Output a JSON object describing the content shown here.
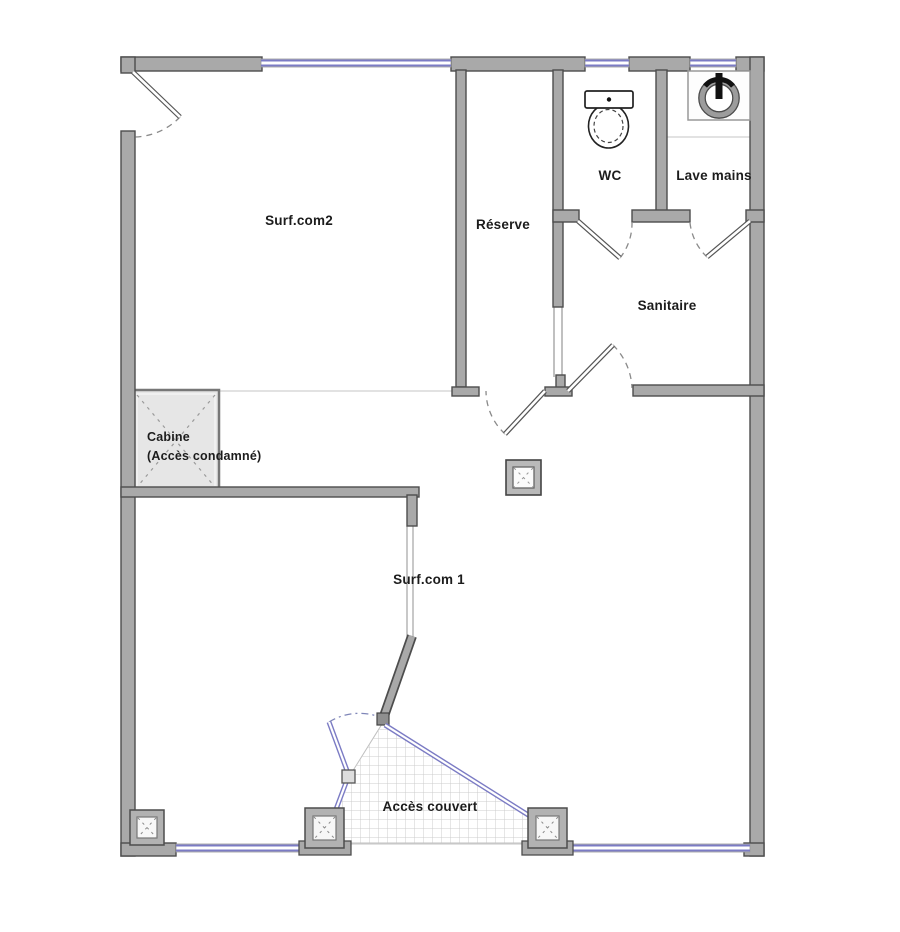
{
  "plan": {
    "rooms": {
      "surfcom2": "Surf.com2",
      "reserve": "Réserve",
      "wc": "WC",
      "lave_mains": "Lave mains",
      "sanitaire": "Sanitaire",
      "cabine": "Cabine",
      "cabine_note": "(Accès condamné)",
      "surfcom1": "Surf.com 1",
      "acces_couvert": "Accès couvert"
    },
    "icons": {
      "toilet": "toilet-icon",
      "sink": "sink-icon",
      "posts": "column-post-icon"
    },
    "colors": {
      "wall_fill": "#a9a9a9",
      "wall_edge": "#4d4d4d",
      "glazing_blue": "#7b7bc4",
      "cabine_fill": "#e6e6e6",
      "hatch_line": "#cccccc",
      "door_arc": "#8a8a8a",
      "floor_line": "#d0d0d0"
    }
  }
}
